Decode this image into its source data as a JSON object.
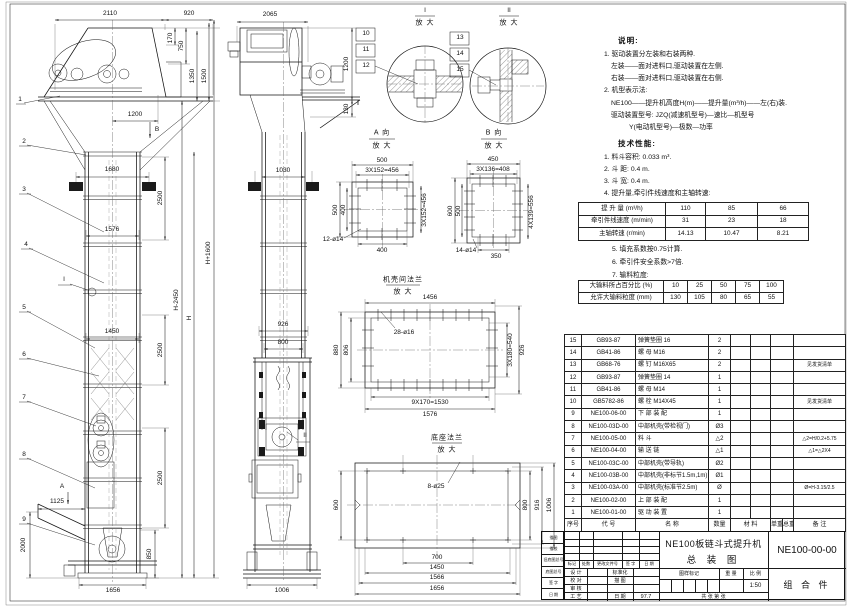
{
  "front": {
    "leaders": [
      "1",
      "2",
      "3",
      "4",
      "5",
      "6",
      "7",
      "8",
      "9"
    ],
    "marker_a": "A",
    "marker_b": "B",
    "marker_i": "I",
    "dims": {
      "d2110": "2110",
      "d920": "920",
      "d170": "170",
      "d750": "750",
      "d1350": "1350",
      "d1500": "1500",
      "d1200": "1200",
      "d1680": "1680",
      "d2500a": "2500",
      "d1576": "1576",
      "d1450": "1450",
      "d2500b": "2500",
      "d2500c": "2500",
      "d1125": "1125",
      "d2000": "2000",
      "d850": "850",
      "d1656": "1656",
      "dH1600": "H+1600",
      "dH2450": "H-2450",
      "dH": "H"
    }
  },
  "side": {
    "marker_ii": "II",
    "dims": {
      "d2065": "2065",
      "d1200": "1200",
      "d130": "130",
      "d1030": "1030",
      "d926": "926",
      "d800": "800",
      "d1006": "1006"
    }
  },
  "detail1": {
    "title": "I",
    "sub": "放 大",
    "leaders": [
      "10",
      "11",
      "12"
    ]
  },
  "detail2": {
    "title": "II",
    "sub": "放 大",
    "leaders": [
      "13",
      "14",
      "15"
    ]
  },
  "viewA": {
    "title": "A 向",
    "sub": "放 大",
    "dims": {
      "top1": "500",
      "top2": "3X152=456",
      "left1": "500",
      "left2": "400",
      "right": "3X152=456",
      "bottom": "400",
      "holes": "12-ø14"
    }
  },
  "viewB": {
    "title": "B 向",
    "sub": "放 大",
    "dims": {
      "top1": "450",
      "top2": "3X136=408",
      "left1": "600",
      "left2": "500",
      "right": "4X139=556",
      "bottom": "350",
      "holes": "14-ø14"
    }
  },
  "flange": {
    "title": "机壳间法兰",
    "sub": "放 大",
    "dims": {
      "top": "1456",
      "left1": "880",
      "left2": "806",
      "right1": "3X180=540",
      "right2": "926",
      "bottom1": "9X170=1530",
      "bottom2": "1576",
      "holes": "28-ø16"
    }
  },
  "base": {
    "title": "底座法兰",
    "sub": "放 大",
    "dims": {
      "left": "600",
      "right1": "800",
      "right2": "916",
      "right3": "1006",
      "bottom1": "700",
      "bottom2": "1450",
      "bottom3": "1566",
      "bottom4": "1656",
      "holes": "8-ø25"
    }
  },
  "notes": {
    "heading": "说明:",
    "n1": "1. 驱动装置分左装和右装两种.",
    "n1a": "左装——面对进料口,驱动装置在左侧.",
    "n1b": "右装——面对进料口,驱动装置在右侧.",
    "n2": "2. 机型表示法:",
    "n2a": "NE100——提升机高度H(m)——提升量(m³/h)——左(右)装.",
    "n2b": "驱动装置型号: JZQ(减速机型号)—速比—机型号",
    "n2c": "Y(电动机型号)—极数—功率"
  },
  "tech": {
    "heading": "技术性能:",
    "t1": "1. 料斗容积: 0.033 m³.",
    "t2": "2. 斗  距: 0.4 m.",
    "t3": "3. 斗  宽: 0.4 m.",
    "t4": "4. 提升量,牵引件线速度和主轴转速:",
    "t5": "5. 填充系数按0.75计算.",
    "t6": "6. 牵引件安全系数>7倍.",
    "t7": "7. 输料粒度:",
    "table1": {
      "rows": [
        {
          "label": "提 升 量 (m³/h)",
          "v1": "110",
          "v2": "85",
          "v3": "66"
        },
        {
          "label": "牵引件线速度 (m/min)",
          "v1": "31",
          "v2": "23",
          "v3": "18"
        },
        {
          "label": "主轴转速 (r/min)",
          "v1": "14.13",
          "v2": "10.47",
          "v3": "8.21"
        }
      ]
    },
    "table2": {
      "rows": [
        {
          "label": "大输料所占百分比 (%)",
          "v1": "10",
          "v2": "25",
          "v3": "50",
          "v4": "75",
          "v5": "100"
        },
        {
          "label": "允许大输料粒度 (mm)",
          "v1": "130",
          "v2": "105",
          "v3": "80",
          "v4": "65",
          "v5": "55"
        }
      ]
    }
  },
  "bom": {
    "headers": [
      "序号",
      "代  号",
      "名  称",
      "数量",
      "材  料",
      "单重",
      "总重",
      "备  注"
    ],
    "rows": [
      {
        "seq": "15",
        "code": "GB93-87",
        "name": "弹簧垫圈 16",
        "qty": "2",
        "remark": ""
      },
      {
        "seq": "14",
        "code": "GB41-86",
        "name": "螺 母  M16",
        "qty": "2",
        "remark": ""
      },
      {
        "seq": "13",
        "code": "GB68-76",
        "name": "螺 钉  M16X65",
        "qty": "2",
        "remark": "见发货清单"
      },
      {
        "seq": "12",
        "code": "GB93-87",
        "name": "弹簧垫圈 14",
        "qty": "1",
        "remark": ""
      },
      {
        "seq": "11",
        "code": "GB41-86",
        "name": "螺 母  M14",
        "qty": "1",
        "remark": ""
      },
      {
        "seq": "10",
        "code": "GB5782-86",
        "name": "螺 栓  M14X45",
        "qty": "1",
        "remark": "见发货清单"
      },
      {
        "seq": "9",
        "code": "NE100-06-00",
        "name": "下 部 装 配",
        "qty": "1",
        "remark": ""
      },
      {
        "seq": "8",
        "code": "NE100-03D-00",
        "name": "中部机壳(带检视门)",
        "qty": "Ø3",
        "remark": ""
      },
      {
        "seq": "7",
        "code": "NE100-05-00",
        "name": "料  斗",
        "qty": "△2",
        "remark": "△2=H/0.2+5.75"
      },
      {
        "seq": "6",
        "code": "NE100-04-00",
        "name": "输 送 链",
        "qty": "△1",
        "remark": "△1=△2X4"
      },
      {
        "seq": "5",
        "code": "NE100-03C-00",
        "name": "中部机壳(带导轨)",
        "qty": "Ø2",
        "remark": ""
      },
      {
        "seq": "4",
        "code": "NE100-03B-00",
        "name": "中部机壳(非标节1.5m,1m)",
        "qty": "Ø1",
        "remark": ""
      },
      {
        "seq": "3",
        "code": "NE100-03A-00",
        "name": "中部机壳(标准节2.5m)",
        "qty": "Ø",
        "remark": "Ø=H-3.15/2.5"
      },
      {
        "seq": "2",
        "code": "NE100-02-00",
        "name": "上 部 装 配",
        "qty": "1",
        "remark": ""
      },
      {
        "seq": "1",
        "code": "NE100-01-00",
        "name": "驱 动 装 置",
        "qty": "1",
        "remark": ""
      }
    ]
  },
  "title_block": {
    "rev_headers": [
      "标记",
      "处数",
      "更改文件号",
      "签 字",
      "日 期"
    ],
    "sign_rows": [
      {
        "l": "设 计",
        "r": "标准化",
        "v": ""
      },
      {
        "l": "校 对",
        "r": "描 图",
        "v": ""
      },
      {
        "l": "审 核",
        "r": "",
        "v": ""
      },
      {
        "l": "工 艺",
        "r": "日 期",
        "v": "97.7"
      }
    ],
    "title_line1": "NE100板链斗式提升机",
    "title_line2": "总  装  图",
    "stamp_label": "图样标记",
    "weight_label": "重 量",
    "scale_label": "比 例",
    "scale": "1:50",
    "sheets": "共   张  第   张",
    "drawing_no": "NE100-00-00",
    "part_type": "组 合 件"
  },
  "margin_block": {
    "rows": [
      "描图",
      "描校",
      "旧底图总号",
      "底图总号",
      "签 字",
      "日 期"
    ]
  }
}
